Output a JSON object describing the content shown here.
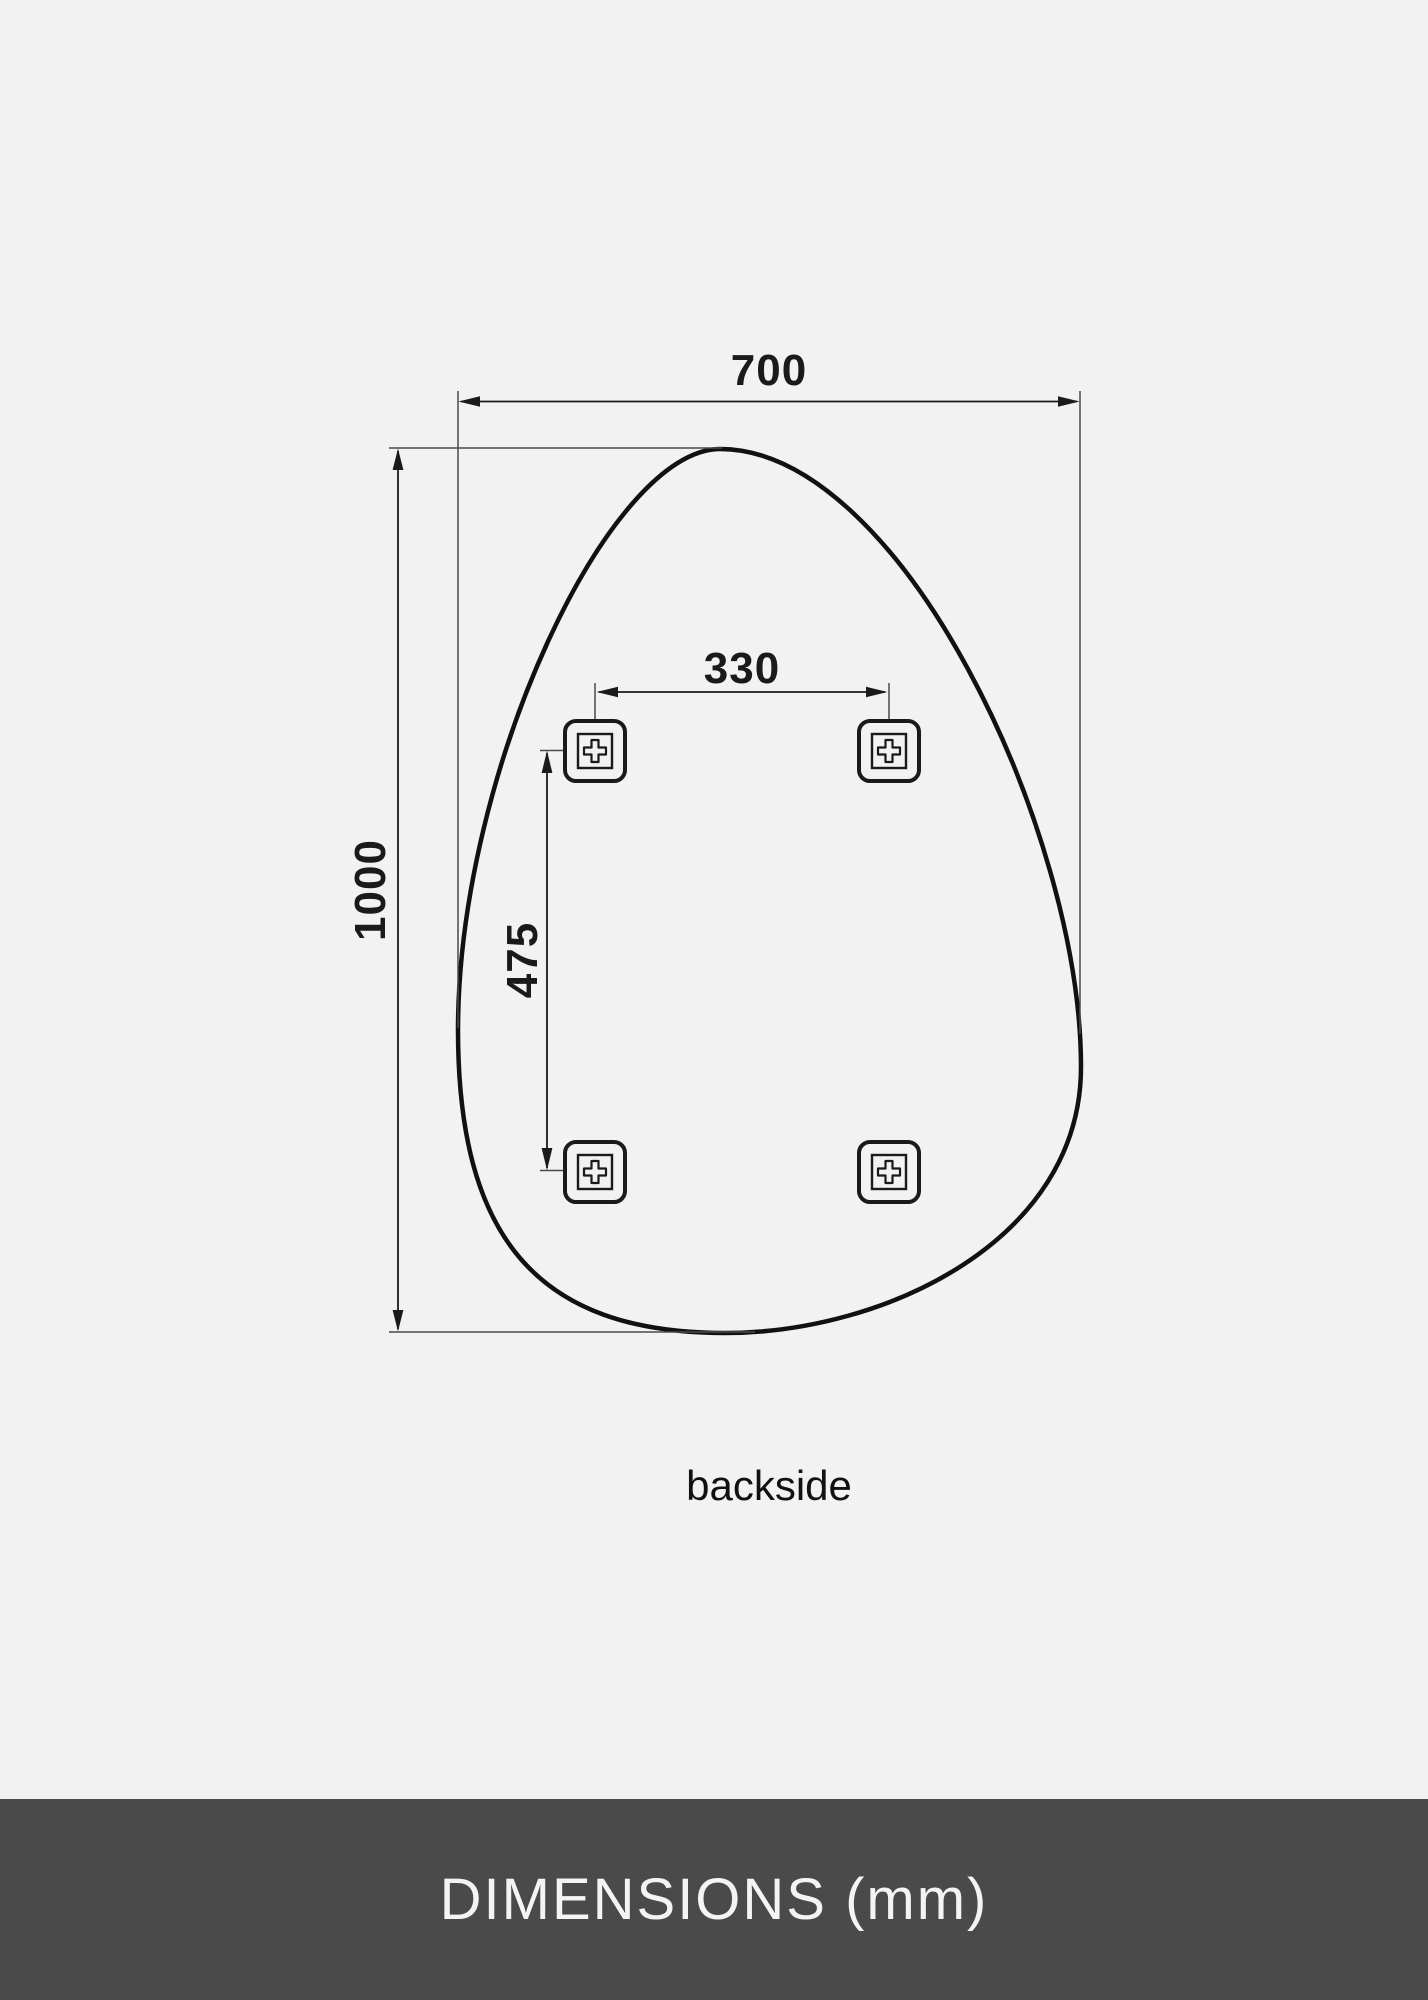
{
  "page": {
    "background": "#f2f2f2",
    "line_color": "#1a1a1a"
  },
  "diagram": {
    "width_label": "700",
    "height_label": "1000",
    "bracket_spacing_horizontal_label": "330",
    "bracket_spacing_vertical_label": "475",
    "view_label": "backside",
    "mount_bracket_count": 4,
    "unit": "mm"
  },
  "footer": {
    "title": "DIMENSIONS (mm)",
    "background": "#4a4a4a",
    "text_color": "#f4f4f4"
  }
}
